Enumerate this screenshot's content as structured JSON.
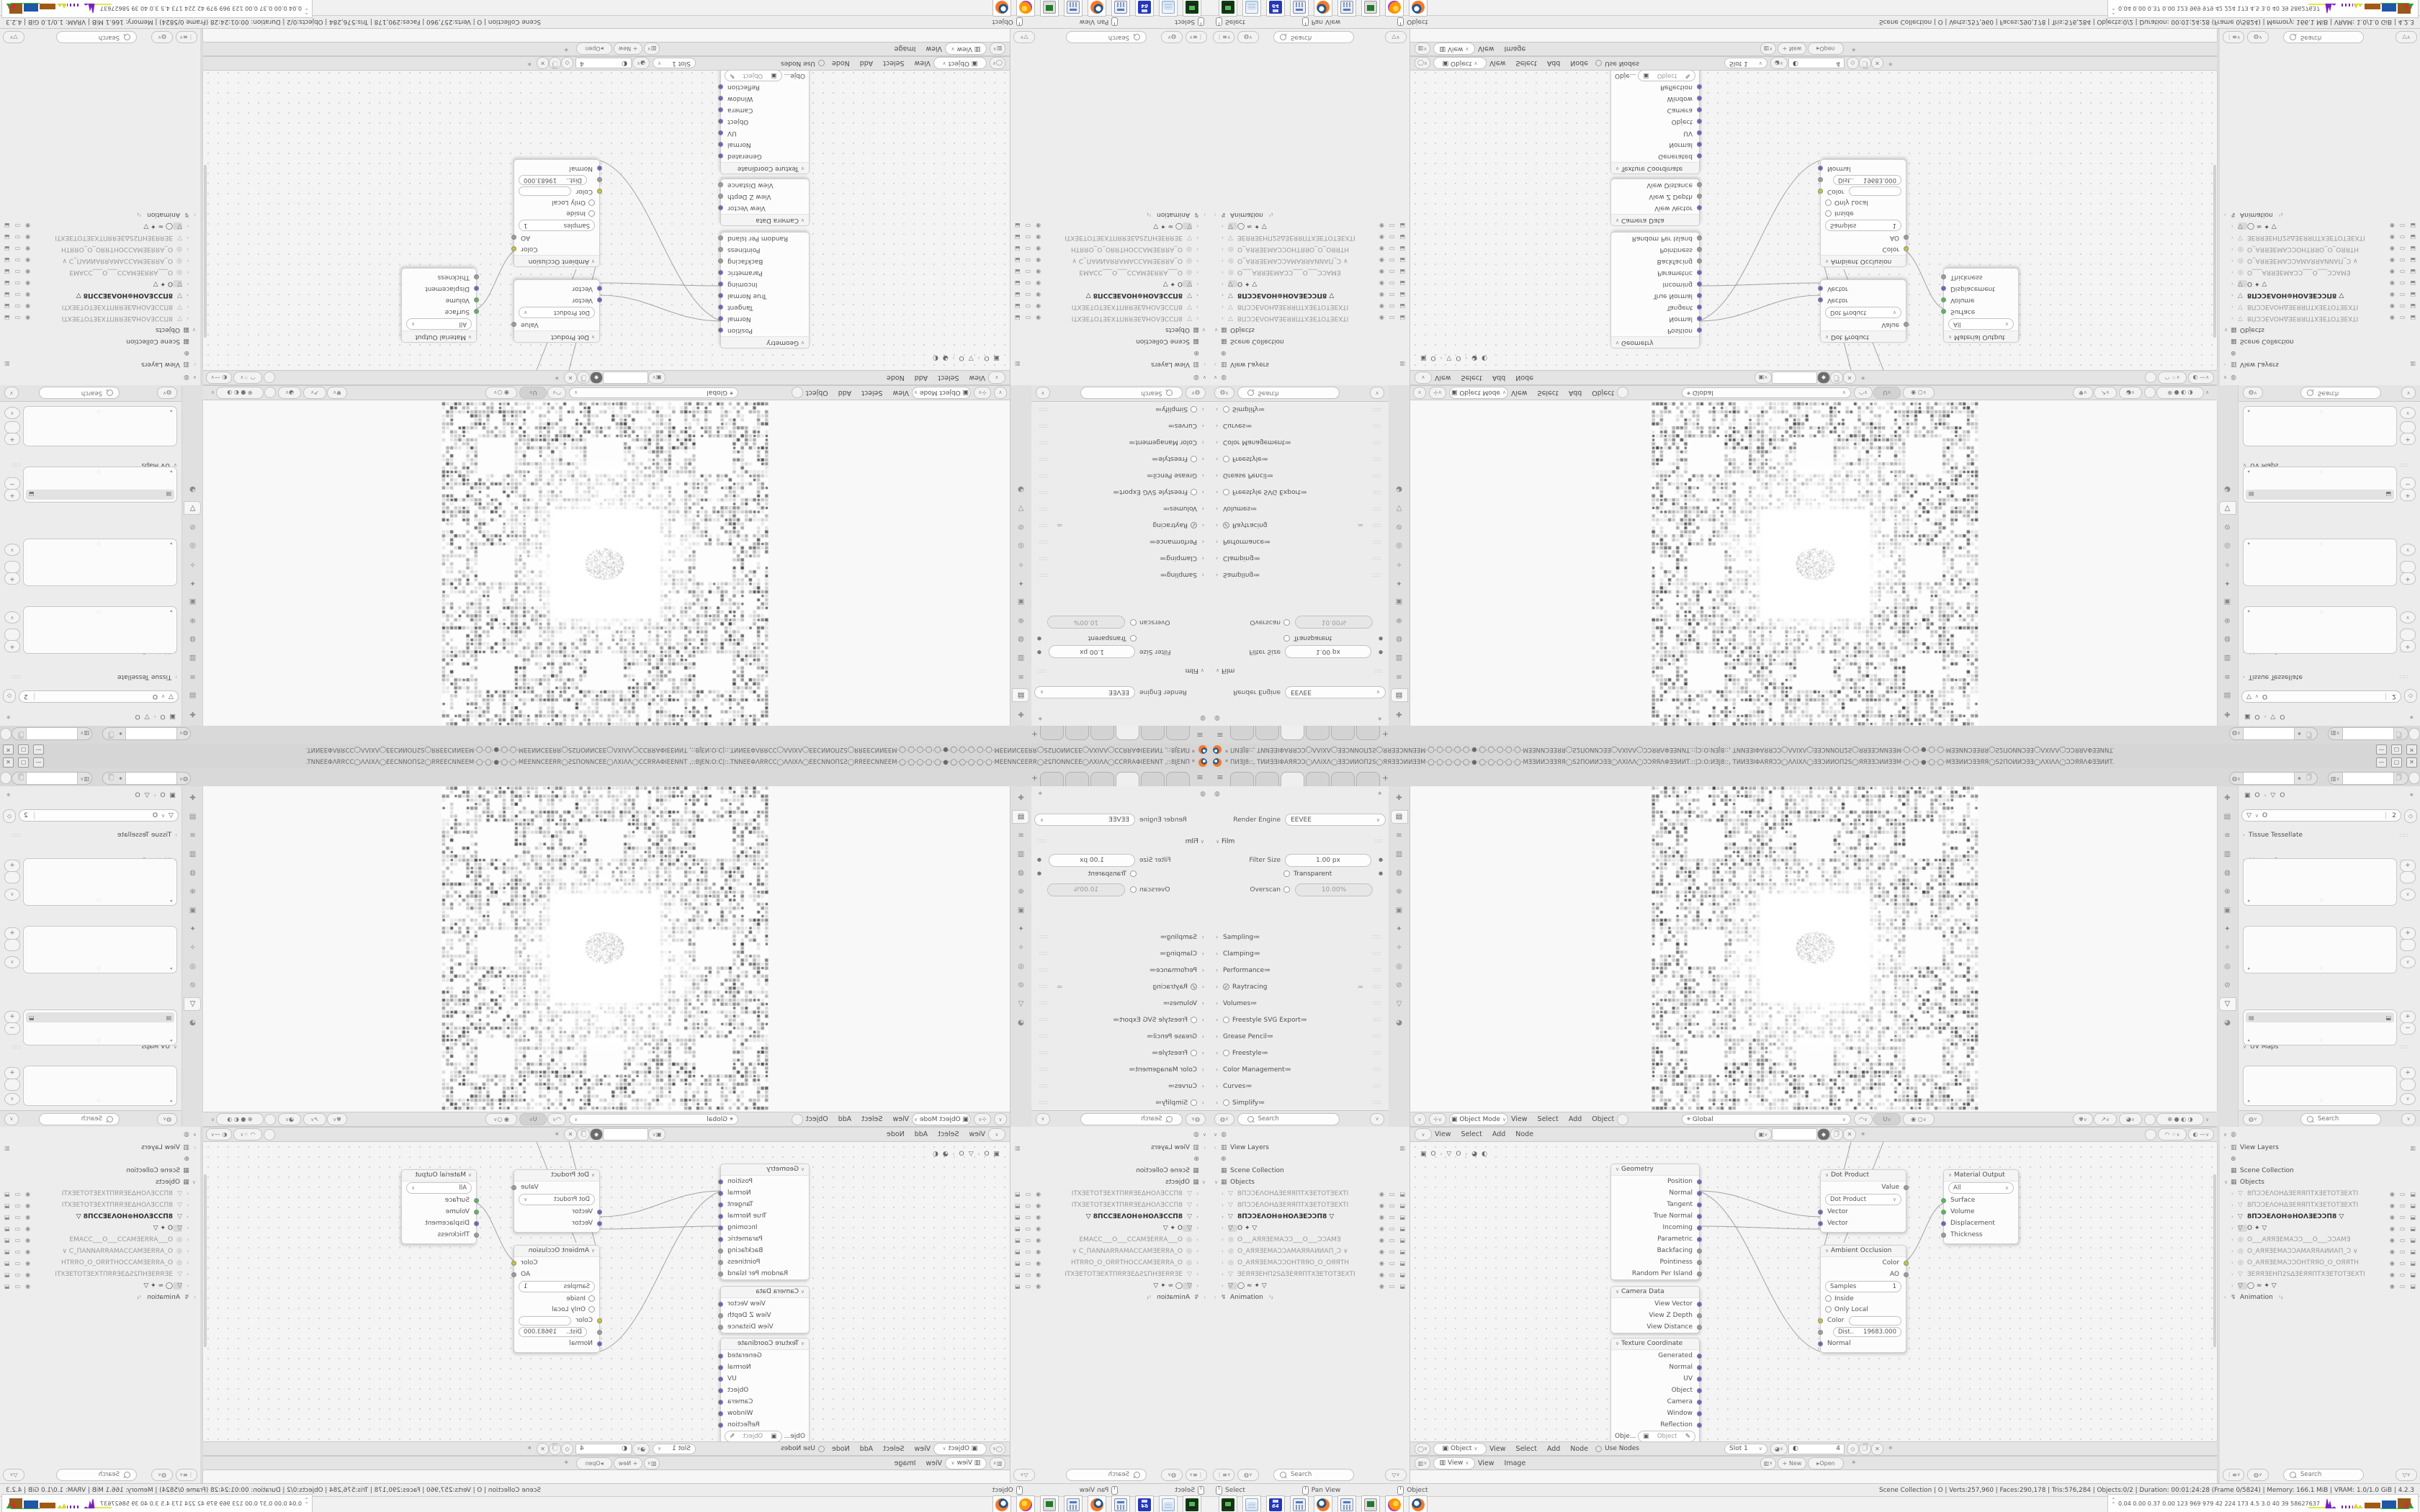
{
  "window": {
    "title": "* ПИƎJ8::, TИИƎƎIΦAЯЯƆƆ◯ΛΛIXΛ◯ƎƎƆИИOΠ2S◯ЯЯƎƎƆИИƎƎM·◯·◯·◯·◯·◯·●·◯·◯·◯·◯·◯·MƎƎИИƆƎƎЯЯ◯S2ΠOИИƆƎƎ◯ΛXIΛΛ◯ƆƆЯЯΛΦƎƎИИT.::|Ɔ:O:ИƎJ8::, TИИƎƎIΦAЯЯƆƆ◯ΛΛIXΛ◯ƎƎƆИИOΠ2S◯ЯЯƎƎƆИИƎƎM·◯·◯·●·◯·◯·MƎƎИИƆƎƎЯЯ◯S2ΠOИИƆƎƎ◯ΛXIΛΛ◯ƆƆЯЯΛΦƎƎИИT.",
    "minimize": "—",
    "maximize": "▢",
    "close": "✕",
    "hamburger": "≡",
    "new_tab": "+"
  },
  "props": {
    "render_engine_label": "Render Engine",
    "render_engine_value": "EEVEE",
    "film_title": "Film",
    "filter_size_label": "Filter Size",
    "filter_size_value": "1.00 px",
    "transparent_label": "Transparent",
    "overscan_label": "Overscan",
    "overscan_value": "10.00%",
    "sections": [
      {
        "label": "Sampling"
      },
      {
        "label": "Clamping"
      },
      {
        "label": "Performance"
      },
      {
        "label": "Raytracing",
        "cls": "ck"
      },
      {
        "label": "Volumes"
      },
      {
        "label": "Freestyle SVG Export",
        "cls": "ci"
      },
      {
        "label": "Grease Pencil"
      },
      {
        "label": "Freestyle",
        "cls": "ci"
      },
      {
        "label": "Color Management"
      },
      {
        "label": "Curves"
      },
      {
        "label": "Simplify",
        "cls": "ci"
      },
      {
        "label": "Depth of Field"
      },
      {
        "label": "Motion Blur",
        "cls": "ci"
      }
    ],
    "search_placeholder": "Search"
  },
  "viewport": {
    "mode": "Object Mode",
    "menus": [
      {
        "label": "View"
      },
      {
        "label": "Select"
      },
      {
        "label": "Add"
      },
      {
        "label": "Object"
      }
    ],
    "orientation": "Global"
  },
  "node_editor": {
    "menus": [
      {
        "label": "View"
      },
      {
        "label": "Select"
      },
      {
        "label": "Add"
      },
      {
        "label": "Node"
      }
    ],
    "breadcrumb_a": "O",
    "breadcrumb_b": "O",
    "geometry": {
      "title": "Geometry",
      "outputs": [
        {
          "label": "Position",
          "c": "#6a63c7"
        },
        {
          "label": "Normal",
          "c": "#6a63c7"
        },
        {
          "label": "Tangent",
          "c": "#6a63c7"
        },
        {
          "label": "True Normal",
          "c": "#6a63c7"
        },
        {
          "label": "Incoming",
          "c": "#6a63c7"
        },
        {
          "label": "Parametric",
          "c": "#6a63c7"
        },
        {
          "label": "Backfacing",
          "c": "#9d9d9d"
        },
        {
          "label": "Pointiness",
          "c": "#9d9d9d"
        },
        {
          "label": "Random Per Island",
          "c": "#9d9d9d"
        }
      ]
    },
    "camera_data": {
      "title": "Camera Data",
      "outputs": [
        {
          "label": "View Vector",
          "c": "#6a63c7"
        },
        {
          "label": "View Z Depth",
          "c": "#9d9d9d"
        },
        {
          "label": "View Distance",
          "c": "#9d9d9d"
        }
      ]
    },
    "texture_coordinate": {
      "title": "Texture Coordinate",
      "outputs": [
        {
          "label": "Generated",
          "c": "#6a63c7"
        },
        {
          "label": "Normal",
          "c": "#6a63c7"
        },
        {
          "label": "UV",
          "c": "#6a63c7"
        },
        {
          "label": "Object",
          "c": "#6a63c7"
        },
        {
          "label": "Camera",
          "c": "#6a63c7"
        },
        {
          "label": "Window",
          "c": "#6a63c7"
        },
        {
          "label": "Reflection",
          "c": "#6a63c7"
        }
      ],
      "object_label": "Obje...",
      "object_value": "Object",
      "from_instancer": "From Instancer"
    },
    "dot_product": {
      "title": "Dot Product",
      "value_label": "Value",
      "op": "Dot Product",
      "inputs": [
        {
          "label": "Vector",
          "c": "#6a63c7"
        },
        {
          "label": "Vector",
          "c": "#6a63c7"
        }
      ]
    },
    "ambient_occlusion": {
      "title": "Ambient Occlusion",
      "outputs": [
        {
          "label": "Color",
          "c": "#c9c92e"
        },
        {
          "label": "AO",
          "c": "#9d9d9d"
        }
      ],
      "samples_label": "Samples",
      "samples_value": "1",
      "inside": "Inside",
      "only_local": "Only Local",
      "color_in": "Color",
      "dist_label": "Dist..",
      "dist_value": "19683.000",
      "normal_in": "Normal"
    },
    "material_output": {
      "title": "Material Output",
      "target": "All",
      "inputs": [
        {
          "label": "Surface",
          "c": "#55bb55"
        },
        {
          "label": "Volume",
          "c": "#55bb55"
        },
        {
          "label": "Displacement",
          "c": "#6a63c7"
        },
        {
          "label": "Thickness",
          "c": "#9d9d9d"
        }
      ]
    },
    "footer": {
      "object": "Object",
      "menus": [
        {
          "label": "View"
        },
        {
          "label": "Select"
        },
        {
          "label": "Add"
        },
        {
          "label": "Node"
        }
      ],
      "use_nodes": "Use Nodes",
      "slot": "Slot 1",
      "count": "4"
    }
  },
  "image_editor": {
    "view": "View",
    "menus": [
      {
        "label": "View"
      },
      {
        "label": "Image"
      }
    ],
    "new_btn": "+ New",
    "open_btn": "Open"
  },
  "outliner": {
    "view_layers": "View Layers",
    "scene_collection": "Scene Collection",
    "objects": "Objects",
    "items": [
      {
        "icon": "▽",
        "label": "8ПƆƆEΛOHΔƎEЯЯПTXƎETOTƎEXTI",
        "cls": "dim"
      },
      {
        "icon": "▽",
        "label": "8ПƆƆEΛOHΔƎEЯЯПTXƎETOTƎEXTI",
        "cls": "dim"
      },
      {
        "icon": "▽",
        "label": "8ПƆƆEΛOH⊕HOΛƎEƆƆП8    ▽",
        "cls": "hl"
      },
      {
        "icon": "▽",
        "label": "O    ✦ ▽",
        "cls": "sel"
      },
      {
        "icon": "◎",
        "label": "O___AЯЯƎEMAƆƆ___O___ƆƆAMƎ",
        "cls": "dim"
      },
      {
        "icon": "◎",
        "label": "O_AЯЯƎEMAƆƆAMAЯЯAИИAП_Ɔ ∨",
        "cls": "dim"
      },
      {
        "icon": "◎",
        "label": "O_AЯЯƎEMAƆƆOHTЯЯO_O_OЯЯTH",
        "cls": "dim"
      },
      {
        "icon": "▽",
        "label": "ƎEЯЯƎEHП2SΔƎEЯЯПTXƎETOTƎEXTI",
        "cls": "dim"
      },
      {
        "icon": "▽",
        "label": "◯    ≈ ✦ ▽",
        "cls": "sel"
      }
    ],
    "animation": "Animation",
    "search_placeholder": "Search"
  },
  "data_props": {
    "breadcrumb_a": "O",
    "breadcrumb_b": "O",
    "name_value": "O",
    "users": "2",
    "tissue": "Tissue Tessellate",
    "vertex_groups": "Vertex Groups",
    "shape_keys": "Shape Keys",
    "add_rest": "Add Rest Position",
    "uv_maps": "UV Maps",
    "color_attributes": "Color Attributes",
    "search_placeholder": "Search"
  },
  "status": {
    "hints": [
      {
        "label": "Select"
      },
      {
        "label": "Pan View"
      },
      {
        "label": "Object"
      }
    ],
    "stats": "Scene Collection | O | Verts:257,960 | Faces:290,178 | Tris:576,284 | Objects:0/2 | Duration: 00:01:24:28 (Frame 0/5824) | Memory: 166.1 MiB | VRAM: 1.0/1.0 GiB | 4.2.3"
  },
  "taskbar": {
    "apps": [
      {
        "cls": "a-console"
      },
      {
        "cls": "a-notepad"
      },
      {
        "cls": "a-floppy"
      },
      {
        "cls": "a-calc"
      },
      {
        "cls": "a-blender"
      },
      {
        "cls": "a-calc"
      },
      {
        "cls": "a-remote"
      },
      {
        "cls": "a-firefox"
      },
      {
        "cls": "a-blender"
      }
    ],
    "perf": "0.04 0.00 0.37 0.00   123   969   979   42   224   173   4.5   3.0   40   39   58627637"
  },
  "icon_strips": {
    "tabs": [
      {
        "g": "✚"
      },
      {
        "g": "▤"
      },
      {
        "g": "≡"
      },
      {
        "g": "▥"
      },
      {
        "g": "◍"
      },
      {
        "g": "⊕"
      },
      {
        "g": "▣"
      },
      {
        "g": "✦"
      },
      {
        "g": "✧"
      },
      {
        "g": "◎"
      },
      {
        "g": "⊘"
      },
      {
        "g": "▽"
      },
      {
        "g": "◕"
      }
    ]
  }
}
